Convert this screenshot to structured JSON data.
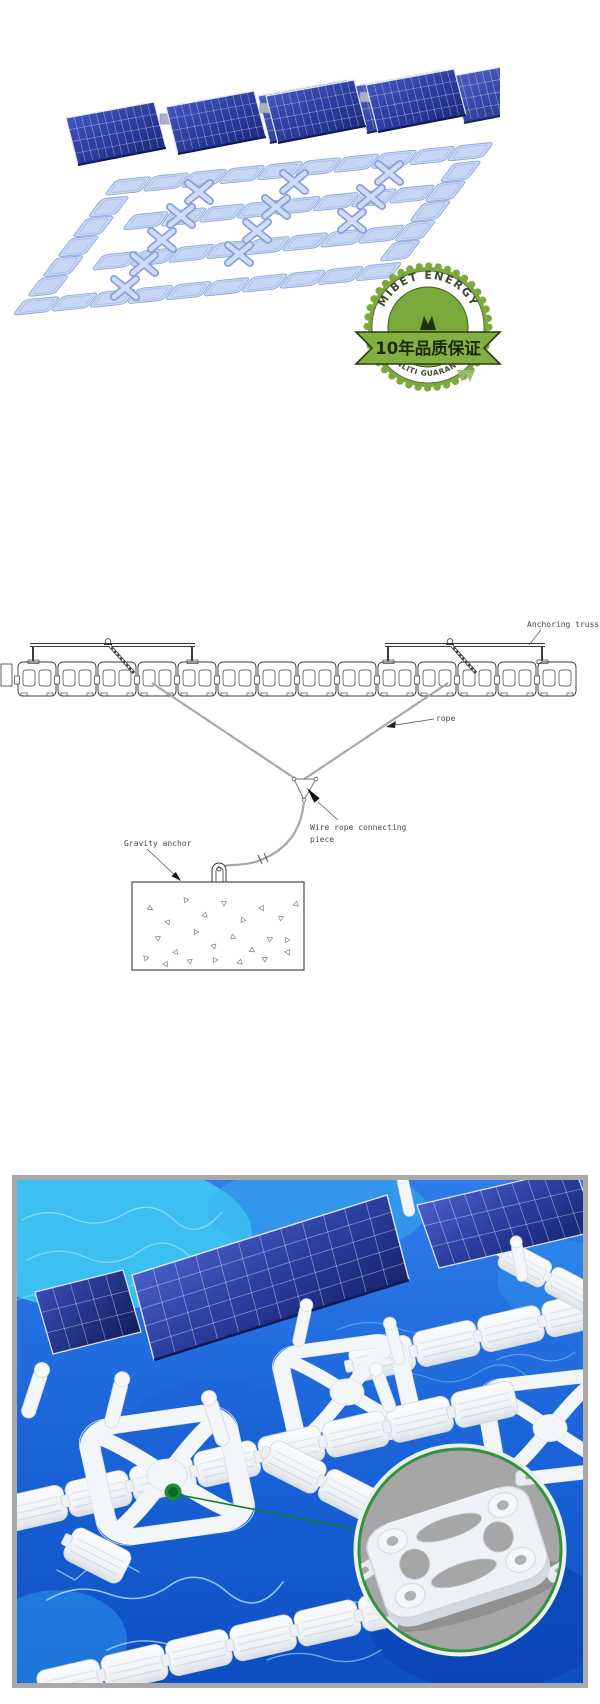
{
  "page": {
    "width": 600,
    "height": 1704,
    "bg": "#ffffff"
  },
  "hero": {
    "colors": {
      "panel_blue": "#2c3da0",
      "panel_sheen": "#4a5ec9",
      "float_blue": "#c6d6f4",
      "float_edge": "#8aa3d6"
    }
  },
  "badge": {
    "arc_top": "MIBET ENERGY",
    "ribbon": "10年品质保证",
    "arc_bottom": "QUANLITI GUARANTEED",
    "colors": {
      "green": "#7aa93c",
      "ribbon_green": "#82b041",
      "outline": "#2c3b16",
      "arc_text": "#3f4a33",
      "ribbon_text": "#1b2a0e"
    }
  },
  "diagram": {
    "labels": {
      "anchoring_truss": "Anchoring truss",
      "rope": "rope",
      "wire_rope_1": "Wire rope connecting",
      "wire_rope_2": "piece",
      "gravity_anchor": "Gravity anchor"
    },
    "ink": "#3a3a3a",
    "rope_gray": "#a8a8a8"
  },
  "photo": {
    "frame_color": "#a9a9a9",
    "marker_green": "#1c8a38",
    "inset_ring_green": "#35913f",
    "inset_bg_gray": "#a6a6a6",
    "water": {
      "deep": "#0d4ec2",
      "mid": "#2f7ce8",
      "bright": "#41d2f4"
    }
  }
}
